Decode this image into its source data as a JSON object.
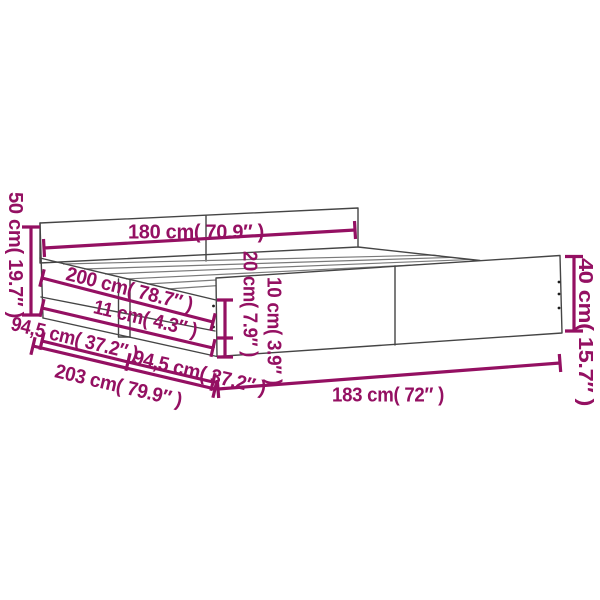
{
  "title": "Bed frame dimension diagram",
  "colors": {
    "dimension_accent": "#941062",
    "outline": "#454545",
    "slat": "#7a7a7a",
    "background": "#ffffff"
  },
  "dimensions": {
    "dim_50cm": {
      "label": "50 cm( 19.7″ )"
    },
    "dim_180cm": {
      "label": "180 cm( 70.9″ )"
    },
    "dim_200cm": {
      "label": "200 cm( 78.7″ )"
    },
    "dim_11cm": {
      "label": "11 cm( 4.3″ )"
    },
    "dim_94_5cm_a": {
      "label": "94,5 cm( 37.2″ )"
    },
    "dim_94_5cm_b": {
      "label": "94,5 cm( 37.2″ )"
    },
    "dim_203cm": {
      "label": "203 cm( 79.9″ )"
    },
    "dim_183cm": {
      "label": "183 cm( 72″ )"
    },
    "dim_40cm": {
      "label": "40 cm( 15.7″ )"
    },
    "dim_20cm": {
      "label": "20 cm( 7.9″ )"
    },
    "dim_10cm": {
      "label": "10 cm( 3.9″ )"
    }
  }
}
